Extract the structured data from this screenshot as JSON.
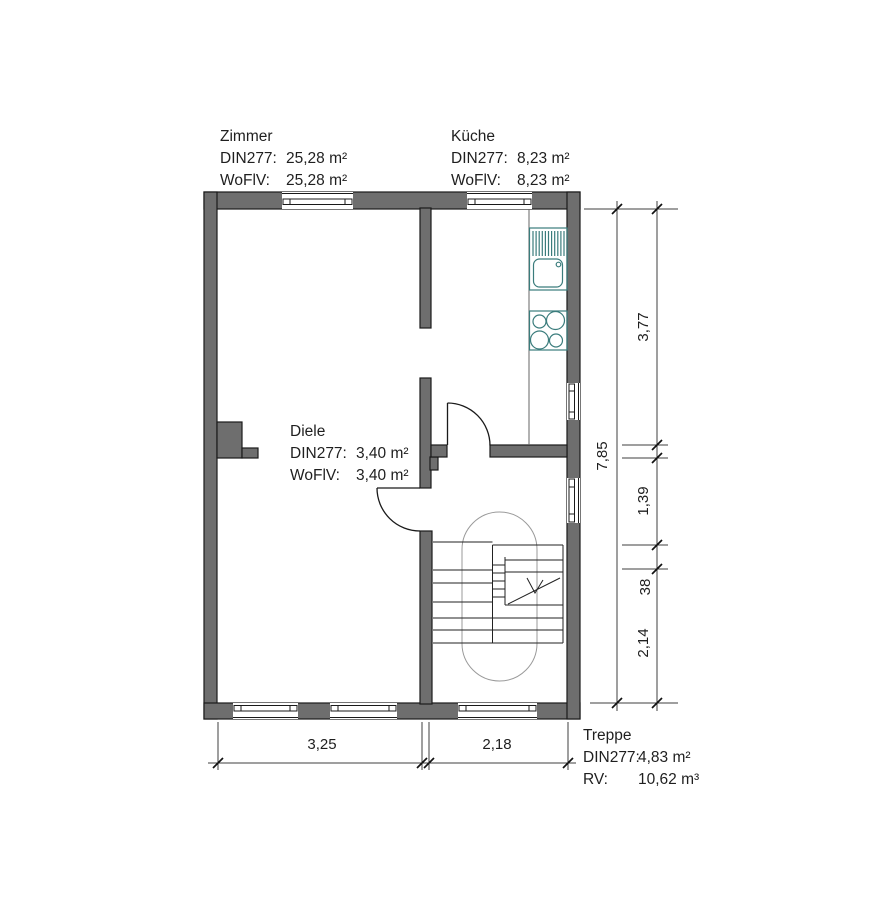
{
  "rooms": {
    "zimmer": {
      "name": "Zimmer",
      "metric1_label": "DIN277:",
      "metric1_value": "25,28 m²",
      "metric2_label": "WoFlV:",
      "metric2_value": "25,28 m²"
    },
    "kueche": {
      "name": "Küche",
      "metric1_label": "DIN277:",
      "metric1_value": "8,23 m²",
      "metric2_label": "WoFlV:",
      "metric2_value": "8,23 m²"
    },
    "diele": {
      "name": "Diele",
      "metric1_label": "DIN277:",
      "metric1_value": "3,40 m²",
      "metric2_label": "WoFlV:",
      "metric2_value": "3,40 m²"
    },
    "treppe": {
      "name": "Treppe",
      "metric1_label": "DIN277:",
      "metric1_value": "4,83 m²",
      "metric2_label": "RV:",
      "metric2_value": "10,62 m³"
    }
  },
  "dimensions": {
    "right_total": "7,85",
    "right_segments": [
      "3,77",
      "1,39",
      "38",
      "2,14"
    ],
    "bottom_segments": [
      "3,25",
      "2,18"
    ]
  },
  "colors": {
    "wall_fill": "#6e6e6e",
    "outline": "#1a1a1a",
    "fixture_stroke": "#3a7c7c",
    "dimension_line": "#3f3f3f",
    "walking_line": "#9a9a9a",
    "text": "#1f1f1f"
  }
}
